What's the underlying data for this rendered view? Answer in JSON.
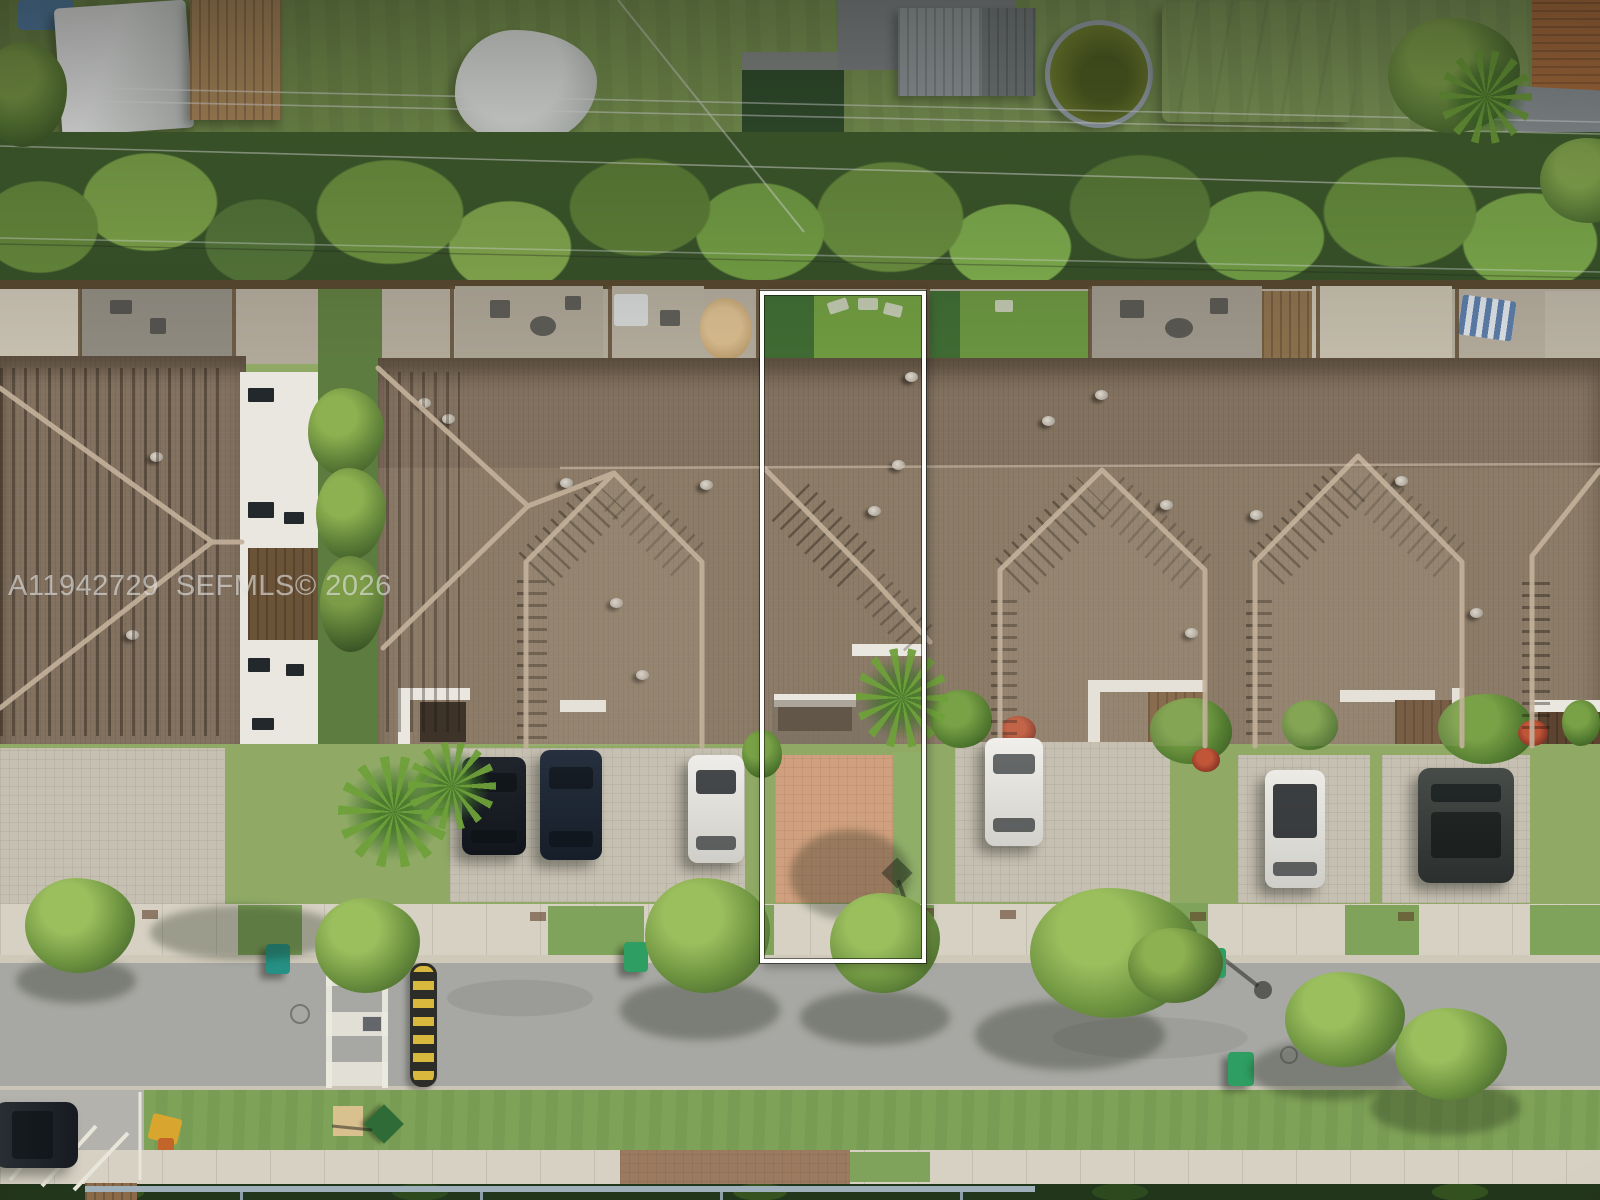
{
  "watermark": {
    "text": "A11942729  SEFMLS© 2026",
    "mls_number": "A11942729",
    "source_label": "SEFMLS©",
    "year": "2026",
    "color": "#ffffff",
    "opacity": 0.55
  },
  "highlight": {
    "purpose": "outline of subject townhouse lot (backyard, roof, courtyard, driveway)",
    "border_color": "#ffffff",
    "inner_line_color": "#000000"
  },
  "scene": {
    "type": "aerial-drone-photo",
    "description": "Top-down aerial photo of a townhouse row: rear yards with patios and artificial turf, continuous brown shingle hip roofs, front courtyards, paver driveways with parked cars, sidewalk, residential street with crosswalk and speed bump, grass verge and perimeter fence. A white rectangle outlines one middle unit.",
    "counts": {
      "parked_cars_driveways": 6,
      "parked_cars_street": 1,
      "trash_bins": 5,
      "roof_hip_gables": 4
    },
    "palette": {
      "roof": "#837263",
      "roof_ridge": "#c3b19b",
      "roof_shadow_comb": "#2a2016",
      "grass": "#7e9a55",
      "trees_dark": "#47682c",
      "trees_light": "#9cbf5e",
      "driveway_pavers": "#c6c0b2",
      "subject_driveway_pavers": "#d0a07e",
      "sidewalk": "#d6d1c3",
      "street": "#a7a7a3",
      "crosswalk": "#e8e6dc",
      "speed_bump_yellow": "#d9b83e",
      "speed_bump_black": "#2c2c28",
      "white_walls": "#e9e7e0",
      "pool_water": "#72812f",
      "bin_teal": "#259083",
      "bin_blue": "#2b57a8",
      "bin_green": "#2f9e62",
      "car_black": "#15191f",
      "car_navy": "#1c2531",
      "car_white": "#e8e6e2",
      "suv_gray": "#3c403d"
    },
    "objects": [
      "rear-alley yards with white canopy tent, wooden shed, gray shed, round pool, large white tent, tarp pile",
      "overhead power lines",
      "hedge tree row with wood fence",
      "unit patios with furniture, umbrellas, turf lawns",
      "continuous brown shingle roof with hip gables and vents",
      "front courtyards with white parapet walls and wood pergolas",
      "paver driveways with parked cars and shrubs",
      "street furniture: trash bins, manholes, street-sign shadows",
      "street with ladder crosswalk and yellow-black speed bump",
      "grass verge with play structure, warning pad, diamond sign",
      "bottom sidewalk, handrail and hedge"
    ]
  }
}
